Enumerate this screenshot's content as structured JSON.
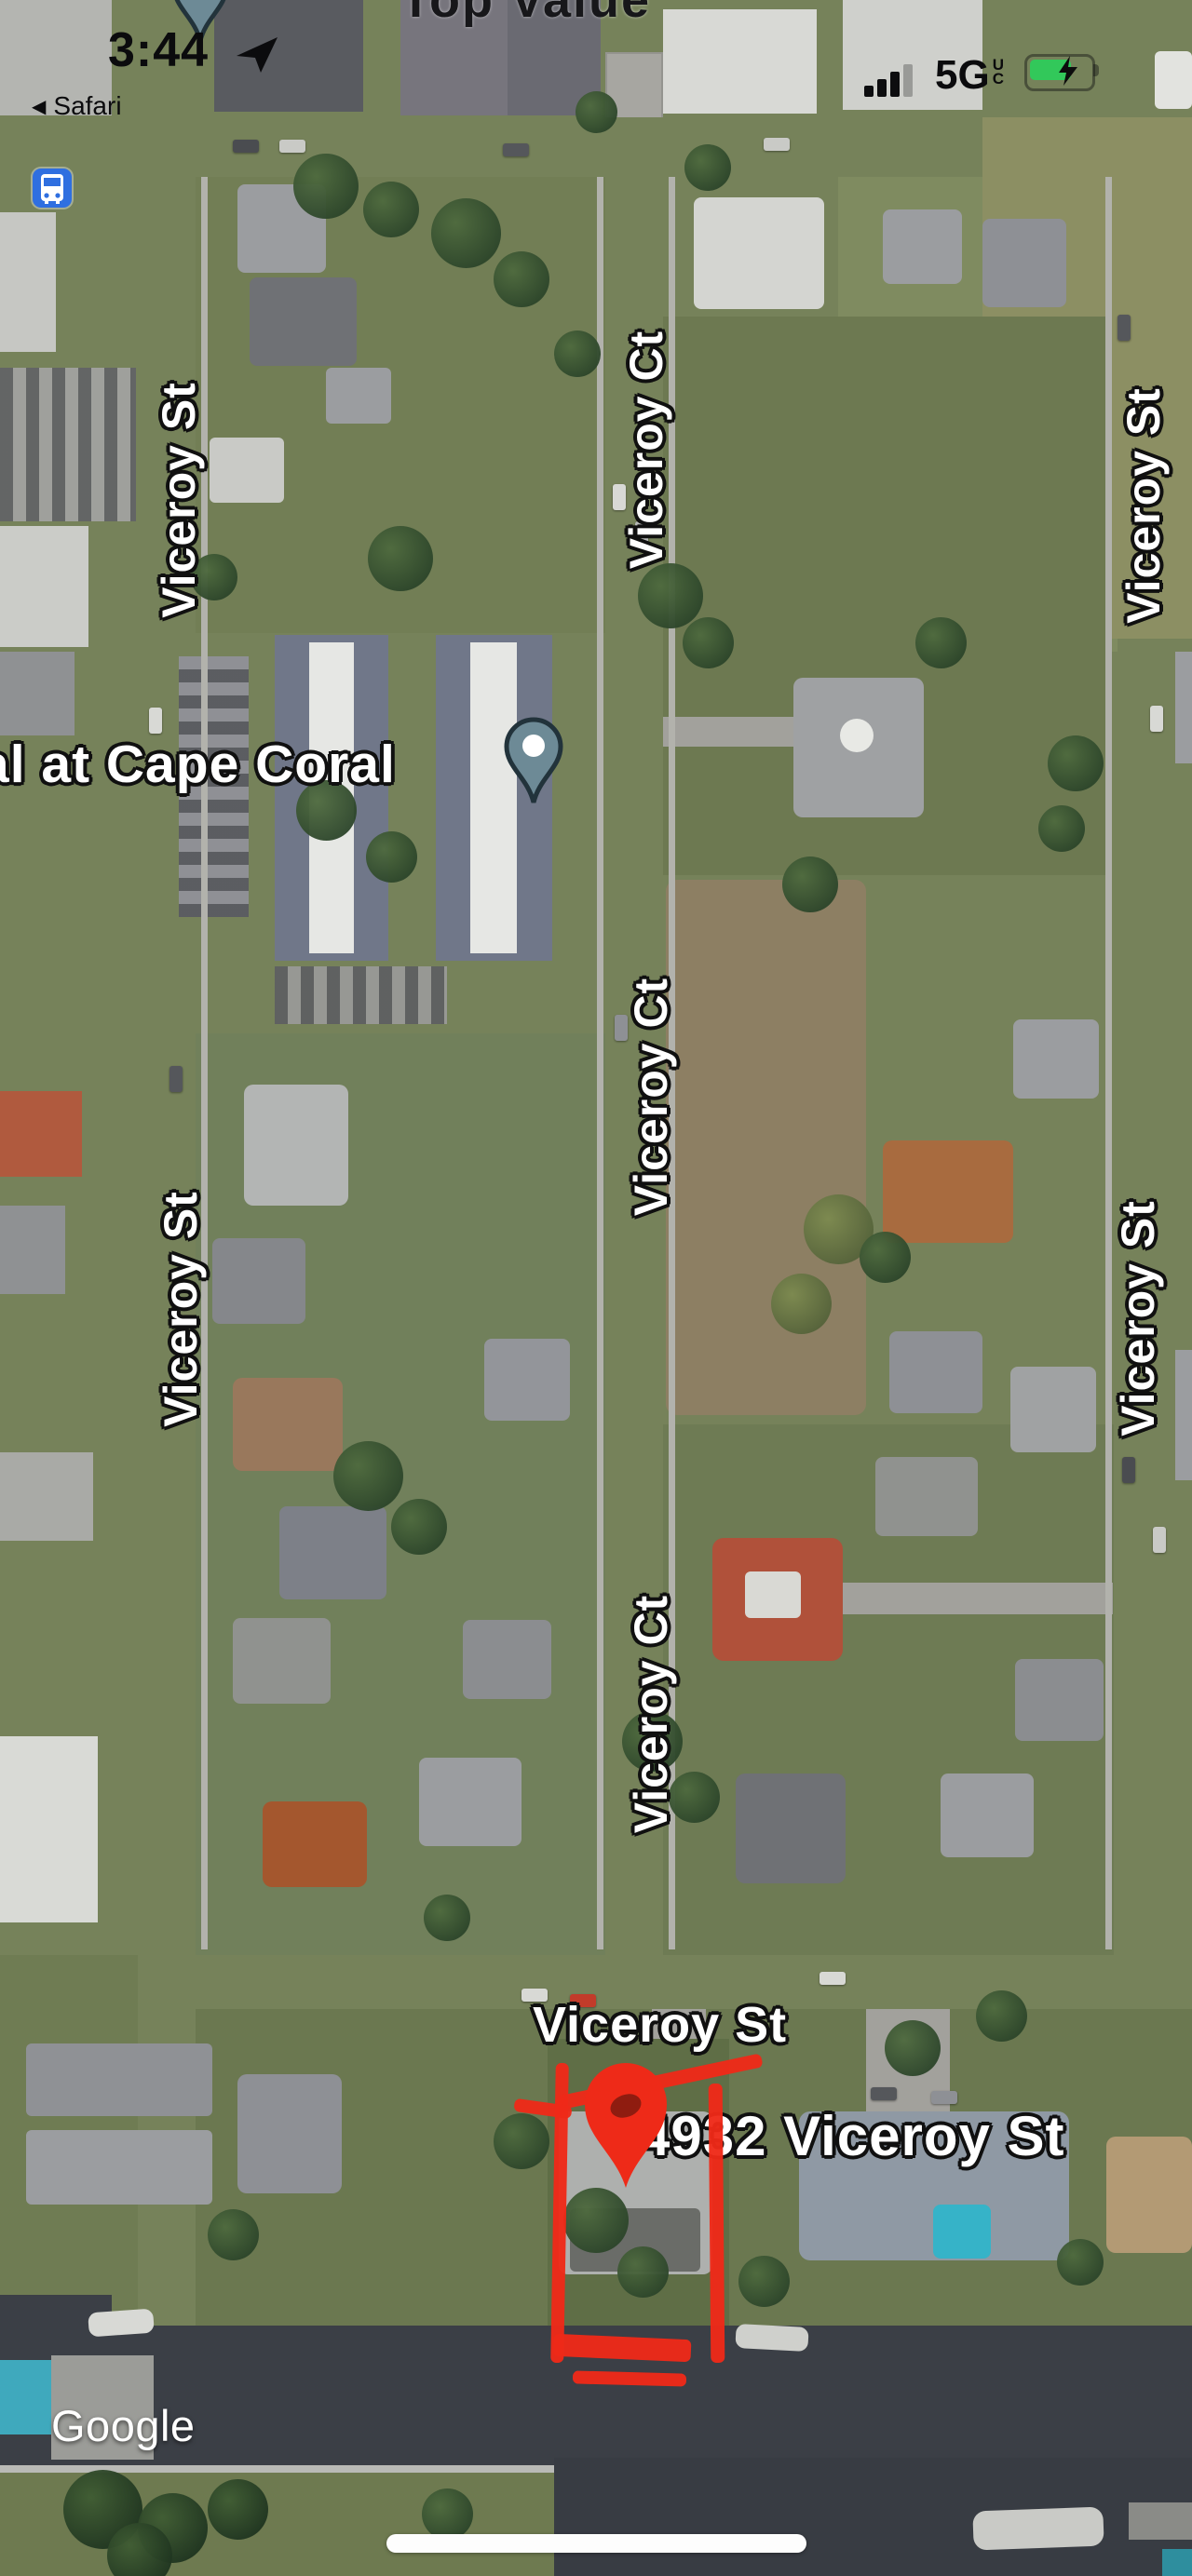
{
  "status_bar": {
    "time": "3:44",
    "back_link": "Safari",
    "network": "5G",
    "network_sub_u": "U",
    "network_sub_c": "C"
  },
  "map": {
    "partial_top_label": "Top Value",
    "place_label": "al at Cape Coral",
    "address_label": "4932 Viceroy St",
    "street_labels": [
      {
        "label": "Viceroy St",
        "position": "left-upper"
      },
      {
        "label": "Viceroy Ct",
        "position": "center-upper"
      },
      {
        "label": "Viceroy St",
        "position": "right-upper"
      },
      {
        "label": "Viceroy Ct",
        "position": "center-middle"
      },
      {
        "label": "Viceroy St",
        "position": "left-lower"
      },
      {
        "label": "Viceroy St",
        "position": "right-lower"
      },
      {
        "label": "Viceroy Ct",
        "position": "center-lower"
      },
      {
        "label": "Viceroy St",
        "position": "bottom-horizontal"
      }
    ],
    "watermark": "Google"
  },
  "icons": {
    "location_arrow": "location-arrow-icon",
    "signal": "cellular-signal-icon",
    "battery": "battery-charging-icon",
    "transit_stop": "bus-stop-icon",
    "poi_pin": "map-pin-icon",
    "red_marker": "red-address-marker-icon"
  },
  "colors": {
    "annotation_red": "#ee2a18",
    "battery_green": "#32c85a",
    "transit_blue": "#2f6fe0",
    "poi_pin_slate": "#6d8a96",
    "water": "#3b3f46",
    "road": "#a7a6a1"
  }
}
